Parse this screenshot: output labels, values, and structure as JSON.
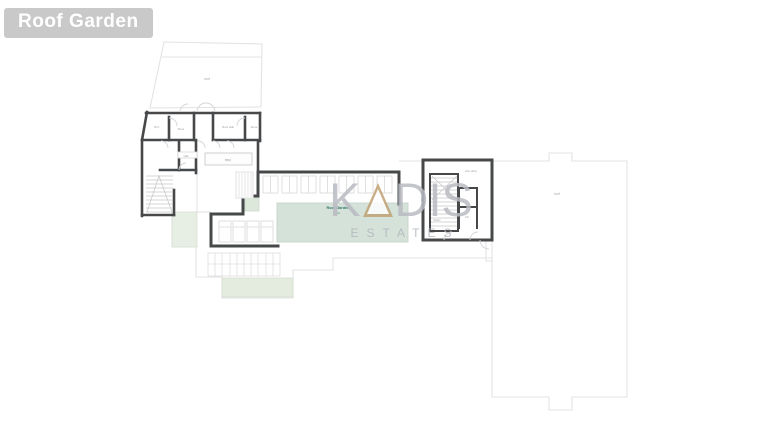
{
  "title": {
    "text": "Roof Garden"
  },
  "watermark": {
    "brand_left": "K",
    "brand_mid": "A",
    "brand_right": "DIS",
    "subtitle": "ESTATES"
  },
  "plan": {
    "pool_label": {
      "line1": "Roof Garden",
      "line2": "m²"
    },
    "labels": {
      "terrace_top": "roof",
      "right_roof": "roof",
      "bbq": "BBQ",
      "room_wc": "W.C.",
      "room_storage": "Store",
      "room_hall": "Roof Hall",
      "room_store2": "Store",
      "stair_room": "Hall",
      "core_lobby": "Lift Lobby",
      "core_lift": "Lift",
      "core_stairs": "Stairs"
    }
  },
  "colors": {
    "chip_bg": "#c9c9c9",
    "wall": "#47484a",
    "line_light": "#e3e3e6",
    "pool_green": "#d5e2da",
    "soft_green": "#e7eee3",
    "strip_green": "#e4ecdf",
    "gold": "#bfa273",
    "watermark_gray": "#b9bcc3",
    "teal_text": "#2e7268",
    "label_gray": "#9aa0a4"
  }
}
